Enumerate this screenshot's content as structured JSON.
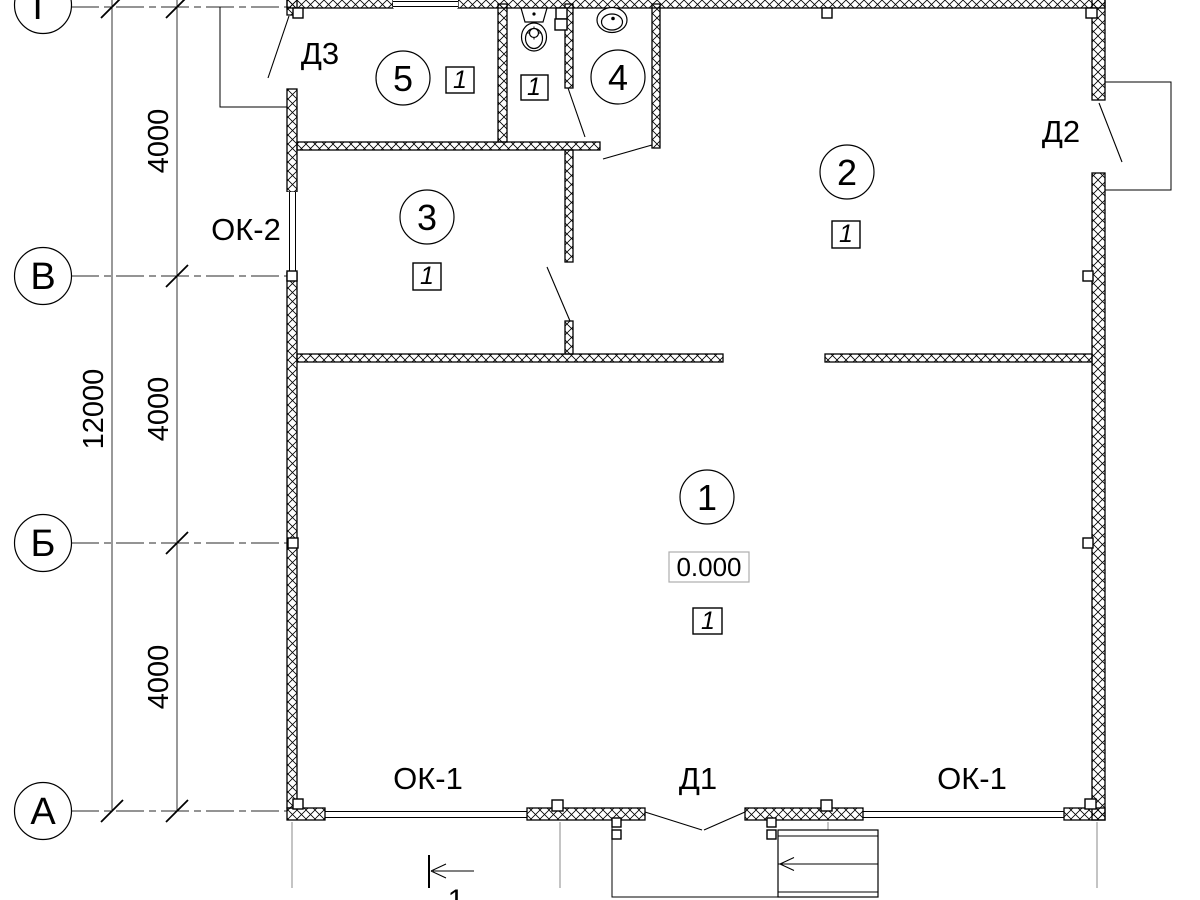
{
  "plan": {
    "axes": [
      {
        "label": "Г"
      },
      {
        "label": "В"
      },
      {
        "label": "Б"
      },
      {
        "label": "А"
      }
    ],
    "dimensions": {
      "overall": "12000",
      "bays": [
        "4000",
        "4000",
        "4000"
      ]
    },
    "rooms": [
      {
        "number": "1",
        "floor": "1",
        "elevation": "0.000"
      },
      {
        "number": "2",
        "floor": "1"
      },
      {
        "number": "3",
        "floor": "1"
      },
      {
        "number": "4"
      },
      {
        "number": "5",
        "floor": "1"
      }
    ],
    "wc": {
      "floor": "1"
    },
    "doors": {
      "d1": "Д1",
      "d2": "Д2",
      "d3": "Д3"
    },
    "windows": {
      "ok1": "ОК-1",
      "ok2": "ОК-2"
    },
    "section": {
      "number": "1"
    }
  }
}
